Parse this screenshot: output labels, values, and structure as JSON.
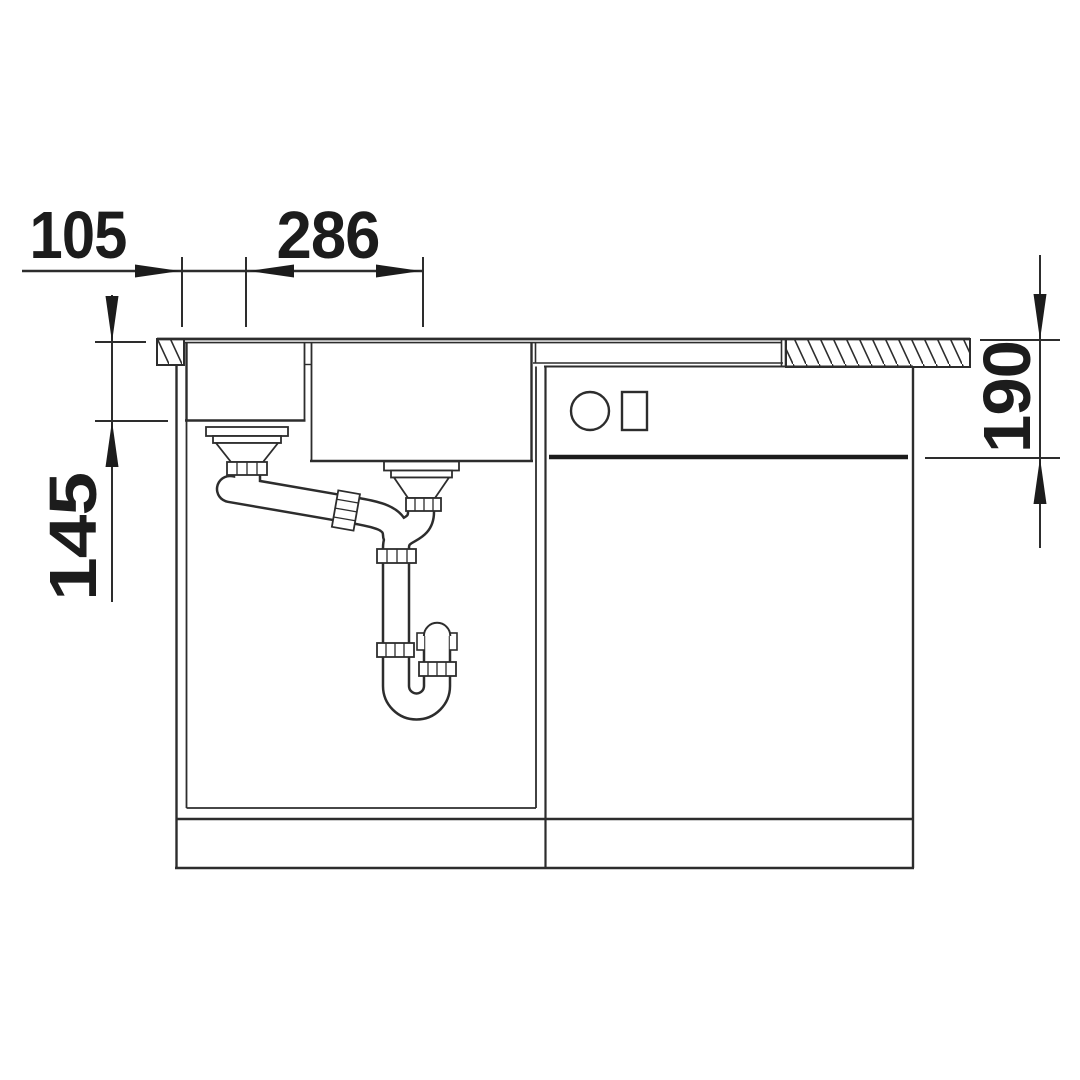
{
  "canvas": {
    "width": 1080,
    "height": 1080,
    "background": "#ffffff",
    "line_color": "#2d2d2d",
    "text_color": "#1c1c1c"
  },
  "drawing": {
    "kind": "kitchen sink installation cross-section technical drawing",
    "dimension_labels": {
      "top_left": "105",
      "top_center": "286",
      "left_vertical": "145",
      "right_vertical": "190"
    }
  }
}
